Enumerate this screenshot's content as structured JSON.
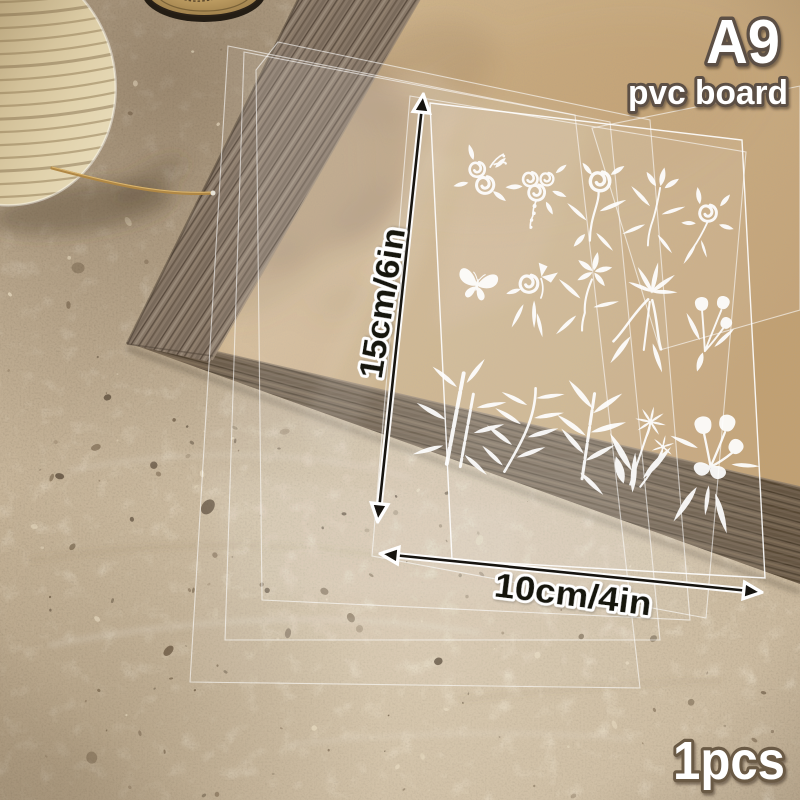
{
  "product": {
    "size_label": "A9",
    "type_label": "pvc board",
    "height_label": "15cm/6in",
    "width_label": "10cm/4in",
    "quantity_label": "1pcs",
    "motifs": [
      "rose-duo",
      "rose-bouquet",
      "rose-stem",
      "leaf-sprig",
      "rose-spray",
      "butterfly",
      "rose-ribbon",
      "blossom-stem",
      "lily-sprig",
      "tulip-trio",
      "bamboo",
      "willow-branch",
      "bamboo-leaves",
      "daisy-sprig",
      "tulip-bouquet"
    ]
  },
  "scene": {
    "props": [
      "woven-basket",
      "candle-jar",
      "dried-stem",
      "wood-frame",
      "kraft-board",
      "clear-pvc-sheets"
    ]
  },
  "colors": {
    "text_white": "#ffffff",
    "text_outline_brown": "#5c5044",
    "dimension_ink": "#17140f",
    "dimension_outline": "#ffffff",
    "stone": "#c7b59a",
    "kraft": "#c9ac82",
    "wood": "#6e5e4d",
    "motif_white": "#ffffff"
  }
}
